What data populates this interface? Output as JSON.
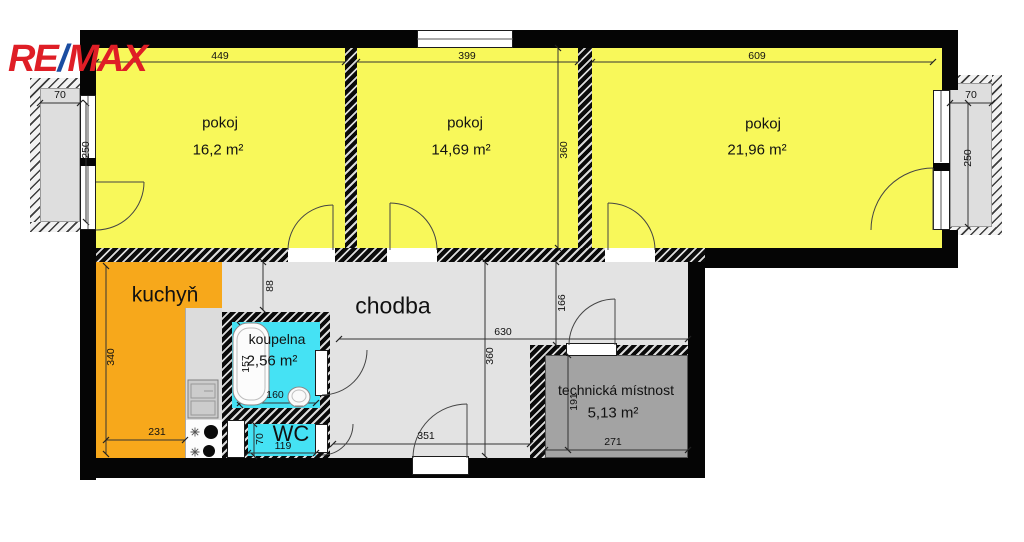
{
  "logo": {
    "re": "RE",
    "slash": "/",
    "max": "MAX"
  },
  "colors": {
    "room_yellow": "#f8f85a",
    "kitchen_orange": "#f7a81b",
    "wet_room_cyan": "#45e2f4",
    "hall_gray": "#e3e3e3",
    "technical_gray": "#a3a3a3",
    "balcony_gray": "#dedede",
    "wall_black": "#050505",
    "logo_red": "#df1e26",
    "logo_blue": "#1b4da1"
  },
  "rooms": {
    "room1": {
      "label": "pokoj",
      "area": "16,2 m²"
    },
    "room2": {
      "label": "pokoj",
      "area": "14,69 m²"
    },
    "room3": {
      "label": "pokoj",
      "area": "21,96 m²"
    },
    "kitchen": {
      "label": "kuchyň"
    },
    "hallway": {
      "label": "chodba"
    },
    "bathroom": {
      "label": "koupelna",
      "area": "2,56 m²"
    },
    "wc": {
      "label": "WC"
    },
    "technical": {
      "label": "technická místnost",
      "area": "5,13 m²"
    }
  },
  "dimensions_cm": {
    "room1_width": "449",
    "room2_width": "399",
    "room3_width": "609",
    "room2_height": "360",
    "balcony_left_depth": "70",
    "balcony_left_width": "250",
    "balcony_right_depth": "70",
    "balcony_right_width": "250",
    "kitchen_height": "340",
    "kitchen_width": "231",
    "kitchen_pass": "88",
    "bath_tub_length": "157",
    "bath_width": "160",
    "wc_height": "70",
    "wc_width": "119",
    "hall_width": "630",
    "hall_height": "360",
    "hall_right_segment": "166",
    "hall_bottom_segment": "351",
    "tech_height": "191",
    "tech_width": "271"
  }
}
